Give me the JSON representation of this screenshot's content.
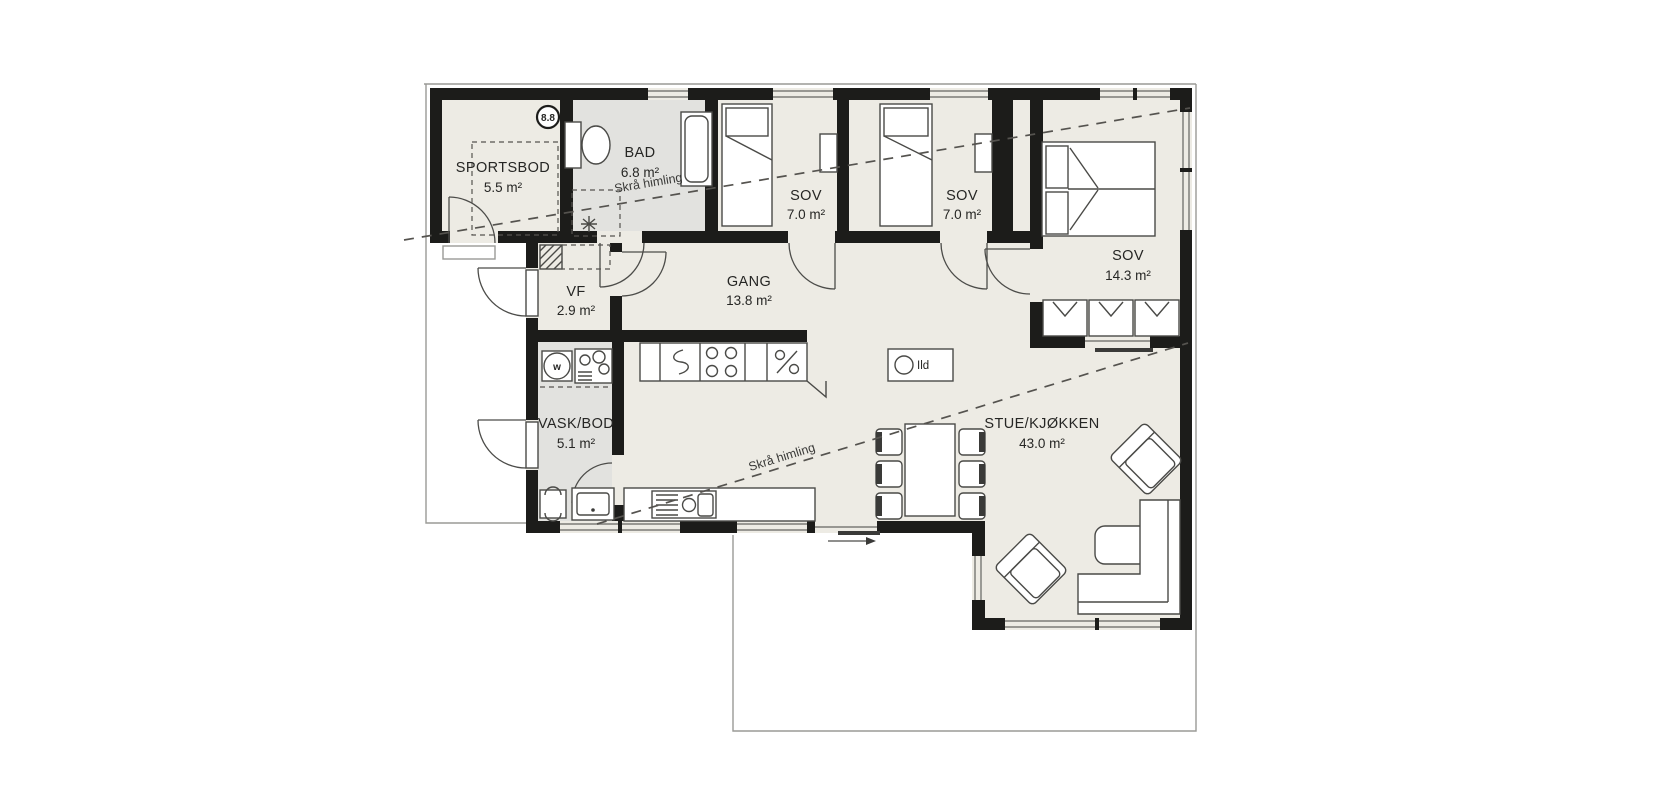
{
  "plan": {
    "title": "floor-plan",
    "rooms": [
      {
        "name": "SPORTSBOD",
        "area": "5.5 m²"
      },
      {
        "name": "BAD",
        "area": "6.8 m²"
      },
      {
        "name": "SOV",
        "area": "7.0 m²"
      },
      {
        "name": "SOV",
        "area": "7.0 m²"
      },
      {
        "name": "SOV",
        "area": "14.3 m²"
      },
      {
        "name": "VF",
        "area": "2.9 m²"
      },
      {
        "name": "GANG",
        "area": "13.8 m²"
      },
      {
        "name": "VASK/BOD",
        "area": "5.1 m²"
      },
      {
        "name": "STUE/KJØKKEN",
        "area": "43.0 m²"
      }
    ],
    "annotations": {
      "sloped_ceiling_1": "Skrå himling",
      "sloped_ceiling_2": "Skrå himling",
      "fireplace": "Ild",
      "elevation_marker": "8.8",
      "washer": "w"
    },
    "colors": {
      "wall": "#1c1c1a",
      "floor": "#edebe4",
      "wet": "#e2e2df",
      "line": "#4a4a47",
      "thin": "#9a9a96",
      "glass": "#8b8b87"
    }
  }
}
